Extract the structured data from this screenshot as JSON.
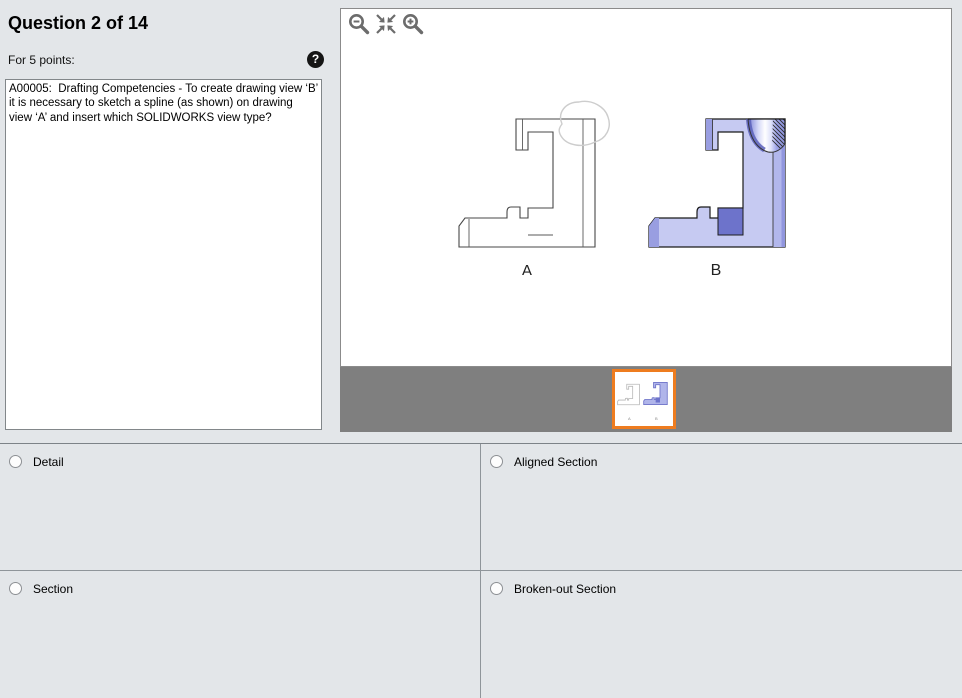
{
  "header": {
    "title": "Question 2 of 14",
    "points_label": "For 5 points:",
    "help_icon_glyph": "?"
  },
  "question": {
    "text": "A00005:  Drafting Competencies - To create drawing view ‘B’ it is necessary to sketch a spline (as shown) on drawing view ‘A’ and insert which SOLIDWORKS view type?"
  },
  "viewer": {
    "toolbar": {
      "zoom_out": "zoom-out",
      "fit": "fit-to-window",
      "zoom_in": "zoom-in"
    },
    "figures": [
      {
        "label": "A"
      },
      {
        "label": "B"
      }
    ],
    "filmstrip": {
      "thumbnail_selected": true,
      "selected_border_color": "#ee7c1f"
    }
  },
  "answers": [
    {
      "label": "Detail",
      "selected": false
    },
    {
      "label": "Aligned Section",
      "selected": false
    },
    {
      "label": "Section",
      "selected": false
    },
    {
      "label": "Broken-out Section",
      "selected": false
    }
  ],
  "colors": {
    "background": "#e3e6e9",
    "filmstrip_gray": "#7f7f7f",
    "accent_orange": "#ee7c1f",
    "part_fill_light": "#c6caf2",
    "part_fill_dark": "#6d73cb",
    "spline_gray": "#cdcdcd"
  }
}
